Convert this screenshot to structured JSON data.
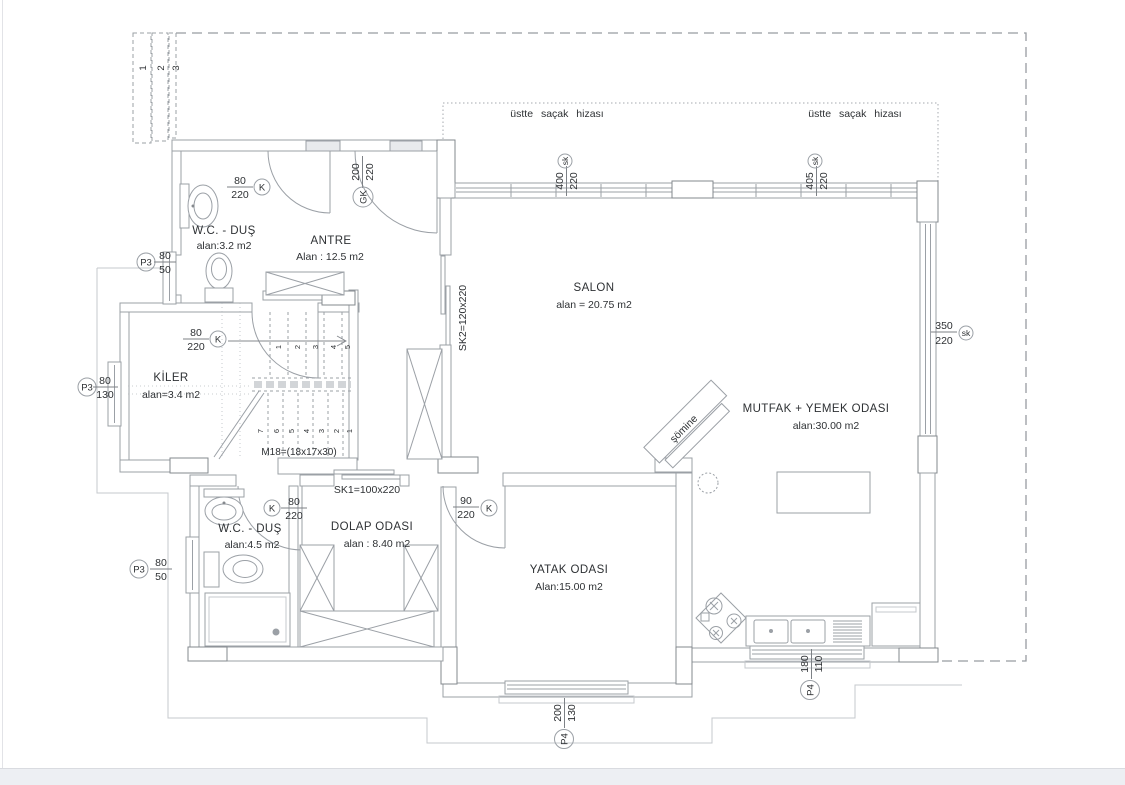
{
  "colors": {
    "line": "#9ba0a6",
    "text": "#2e3134",
    "page_footer": "#edeff3"
  },
  "plan": {
    "eaves_label_left": "üstte saçak hizası",
    "eaves_label_right": "üstte saçak hizası",
    "fireplace_label": "şömine",
    "corner_strips": [
      "1",
      "2",
      "3"
    ]
  },
  "rooms": {
    "wc_top": {
      "name": "W.C. - DUŞ",
      "area": "alan:3.2 m2"
    },
    "antre": {
      "name": "ANTRE",
      "area": "Alan : 12.5 m2"
    },
    "salon": {
      "name": "SALON",
      "area": "alan = 20.75 m2"
    },
    "kiler": {
      "name": "KİLER",
      "area": "alan=3.4 m2"
    },
    "mutfak": {
      "name": "MUTFAK + YEMEK ODASI",
      "area": "alan:30.00 m2"
    },
    "wc_bottom": {
      "name": "W.C. - DUŞ",
      "area": "alan:4.5 m2"
    },
    "dolap": {
      "name": "DOLAP ODASI",
      "area": "alan : 8.40 m2"
    },
    "yatak": {
      "name": "YATAK ODASI",
      "area": "Alan:15.00 m2"
    }
  },
  "doors": {
    "wc_top_door": {
      "w": "80",
      "h": "220",
      "tag": "K"
    },
    "antre_door": {
      "w": "200",
      "h": "220",
      "tag": "GK"
    },
    "kiler_door": {
      "w": "80",
      "h": "220",
      "tag": "K"
    },
    "wc_bottom_door": {
      "w": "80",
      "h": "220",
      "tag": "K"
    },
    "yatak_door": {
      "w": "90",
      "h": "220",
      "tag": "K"
    },
    "sk1": "SK1=100x220",
    "sk2": "SK2=120x220"
  },
  "windows": {
    "salon_top_left": {
      "w": "400",
      "h": "220",
      "tag": "sk"
    },
    "salon_top_right": {
      "w": "405",
      "h": "220",
      "tag": "sk"
    },
    "mutfak_right": {
      "w": "350",
      "h": "220",
      "tag": "sk"
    },
    "wc_top_window": {
      "tag": "P3",
      "w": "80",
      "h": "50"
    },
    "kiler_window": {
      "tag": "P3",
      "w": "80",
      "h": "130"
    },
    "wc_bottom_window": {
      "tag": "P3",
      "w": "80",
      "h": "50"
    },
    "mutfak_bottom_window": {
      "tag": "P4",
      "w": "180",
      "h": "110"
    },
    "yatak_bottom_window": {
      "tag": "P4",
      "w": "200",
      "h": "130"
    }
  },
  "stairs": {
    "label": "M18=(18x17x30)",
    "up": [
      "1",
      "2",
      "3",
      "4",
      "5"
    ],
    "down": [
      "7",
      "6",
      "5",
      "4",
      "3",
      "2",
      "1"
    ]
  }
}
